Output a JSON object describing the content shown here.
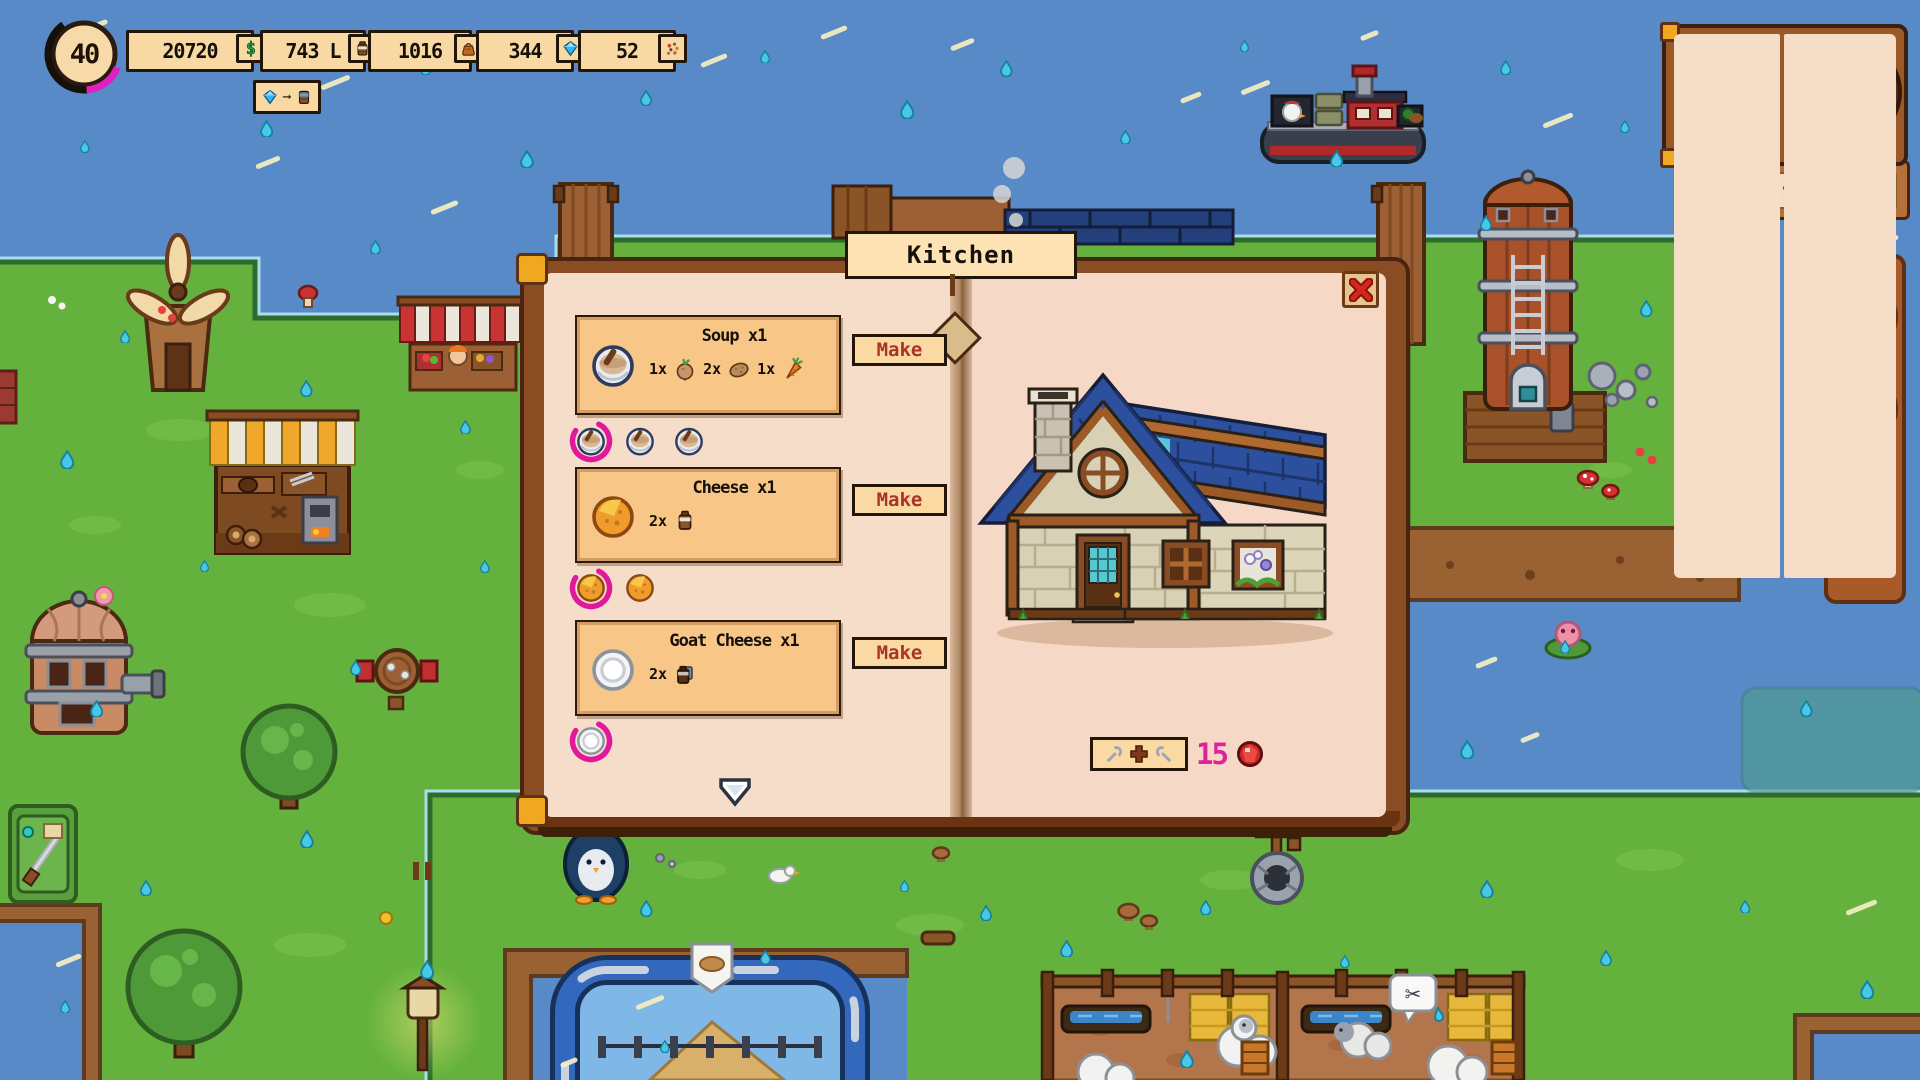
{
  "hud": {
    "level": "40",
    "resources": [
      {
        "label": "20720",
        "icon": "coin-dollar-icon"
      },
      {
        "label": "743 L",
        "icon": "milk-jug-icon"
      },
      {
        "label": "1016",
        "icon": "feed-bag-icon"
      },
      {
        "label": "344",
        "icon": "diamond-icon"
      },
      {
        "label": "52",
        "icon": "seeds-icon"
      }
    ],
    "conversion_chip": {
      "from_icon": "diamond-icon",
      "to_icon": "water-tank-icon"
    }
  },
  "calendar": {
    "weekday": "Tuesday",
    "day_line": "1st day",
    "of_line": "of 2nd",
    "season_line": "Spring",
    "clock": {
      "numbers": [
        "12",
        "3",
        "6",
        "9"
      ]
    }
  },
  "weather_bar": {
    "slots": [
      "moon",
      "rain",
      "phone",
      "",
      ""
    ]
  },
  "profile_panel": {
    "mail_icon": "envelope-icon"
  },
  "book": {
    "title": "Kitchen",
    "recipes": [
      {
        "name": "Soup x1",
        "product_icon": "soup-bowl",
        "ingredients": [
          {
            "qty": "1x",
            "item": "turnip"
          },
          {
            "qty": "2x",
            "item": "potato"
          },
          {
            "qty": "1x",
            "item": "carrot"
          }
        ],
        "make_label": "Make",
        "queued": 3,
        "bookmark": true
      },
      {
        "name": "Cheese x1",
        "product_icon": "cheese-wheel",
        "ingredients": [
          {
            "qty": "2x",
            "item": "milk"
          }
        ],
        "make_label": "Make",
        "queued": 2,
        "bookmark": false
      },
      {
        "name": "Goat Cheese x1",
        "product_icon": "goat-cheese-wheel",
        "ingredients": [
          {
            "qty": "2x",
            "item": "goat-milk"
          }
        ],
        "make_label": "Make",
        "queued": 1,
        "bookmark": false
      }
    ],
    "upgrade": {
      "cost": "15",
      "currency_icon": "red-gem-icon"
    }
  },
  "colors": {
    "accent_magenta": "#e0219c",
    "make_red": "#a83428",
    "ui_tan": "#f8d9a4",
    "water": "#578ac6",
    "grass": "#64b23d"
  }
}
